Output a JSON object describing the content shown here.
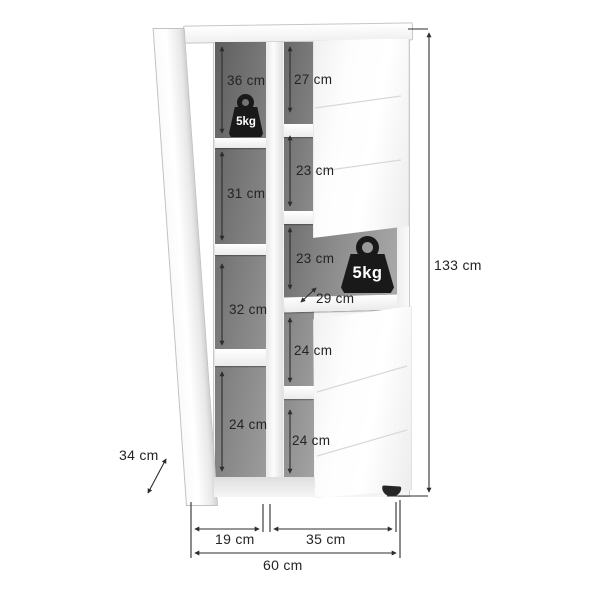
{
  "product_diagram": {
    "kind": "furniture-dimension-diagram",
    "overall": {
      "height": "133 cm",
      "width": "60 cm",
      "depth": "34 cm"
    },
    "bottom_widths": {
      "left_section": "19 cm",
      "right_section": "35 cm",
      "total": "60 cm"
    },
    "left_column_compartment_heights": [
      "36 cm",
      "31 cm",
      "32 cm",
      "24 cm"
    ],
    "middle_column_compartment_heights": [
      "27 cm",
      "23 cm",
      "23 cm",
      "24 cm",
      "24 cm"
    ],
    "shelf_depth": "29 cm",
    "weight_badges": [
      "5kg",
      "5kg"
    ]
  },
  "colors": {
    "background": "#ffffff",
    "cabinet_white": "#f4f4f4",
    "interior_gray_dark": "#5f5f5f",
    "interior_gray_light": "#a3a3a3",
    "dimension_line": "#2d2d2d",
    "weight_black": "#191919"
  }
}
